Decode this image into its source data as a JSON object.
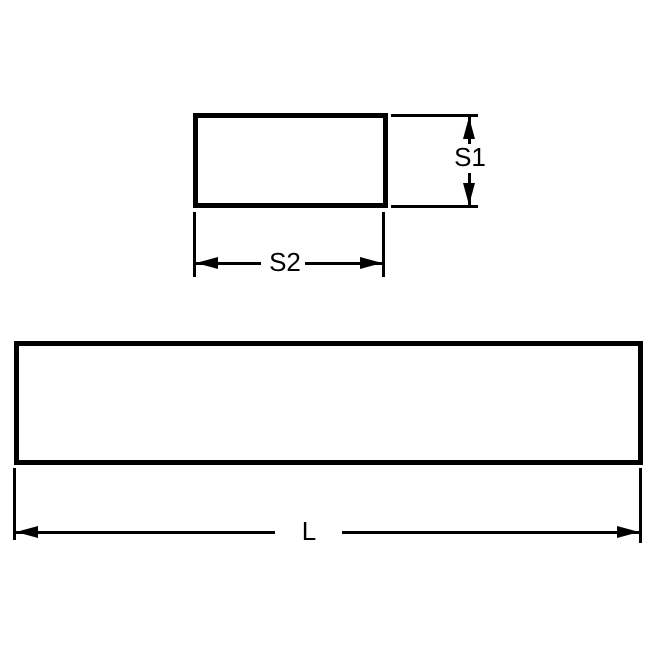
{
  "diagram": {
    "background_color": "#ffffff",
    "line_color": "#000000",
    "cross_section_view": {
      "height_dimension_label": "S1",
      "width_dimension_label": "S2"
    },
    "side_view": {
      "length_dimension_label": "L"
    }
  }
}
